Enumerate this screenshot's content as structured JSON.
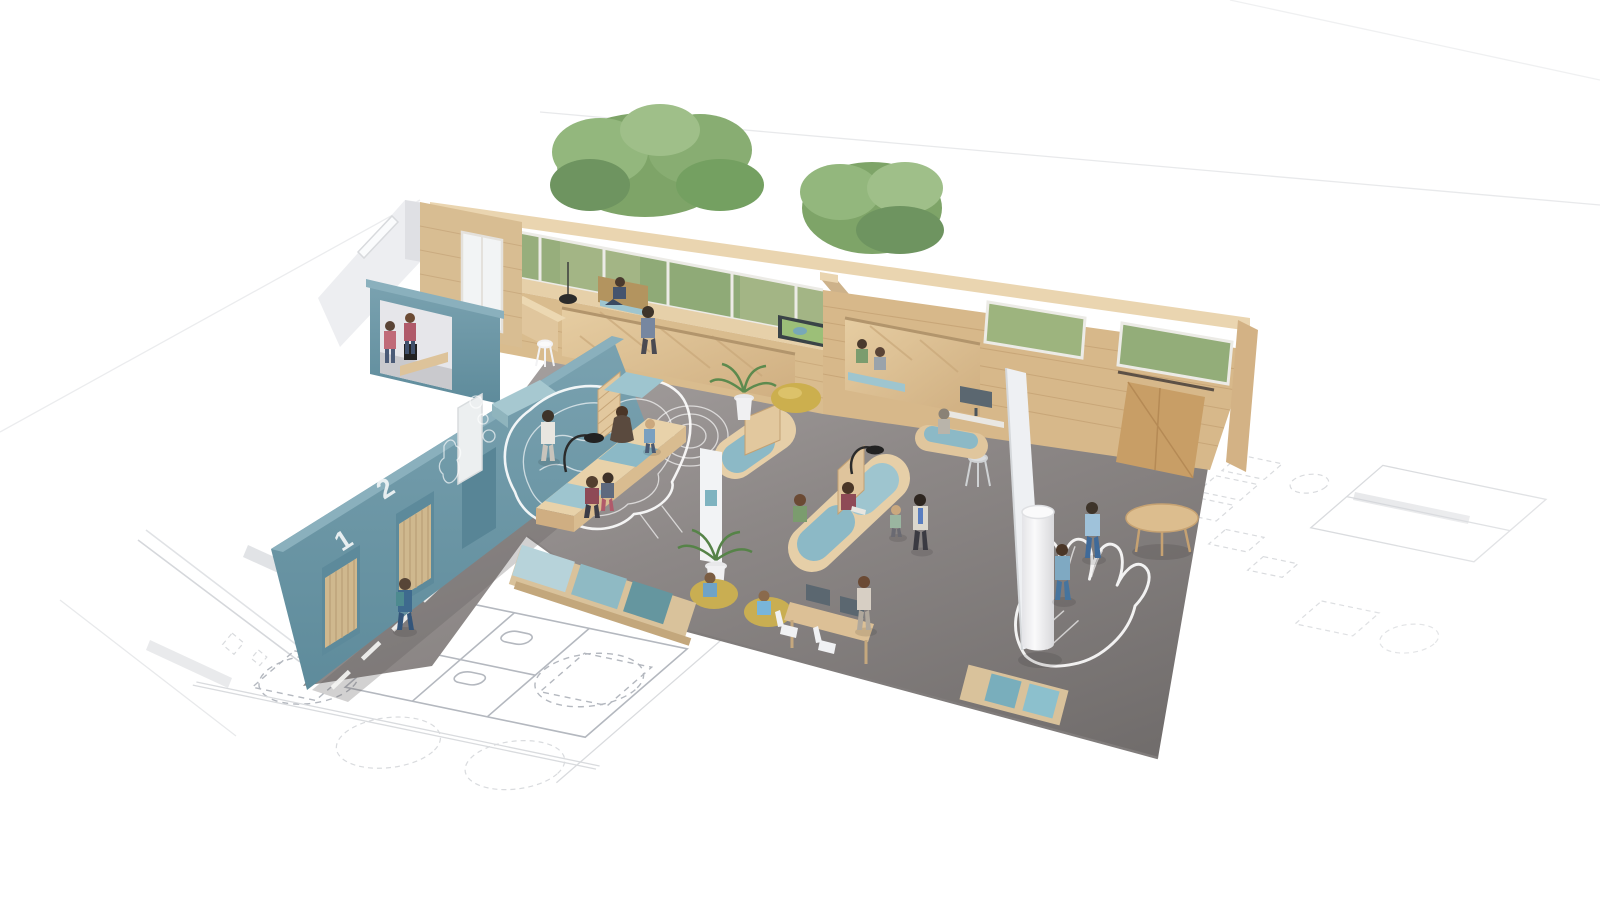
{
  "scene": {
    "description": "Isometric 3D cutaway rendering of a wooden office interior with teal accent wall, placed over a faint architectural blueprint floor plan",
    "door_labels": {
      "door_1": "1",
      "door_2": "2"
    },
    "palette": {
      "background": "#ffffff",
      "blueprint_line": "#b4b8bf",
      "blueprint_line_faint": "#d9dbde",
      "floor_gray": "#8d8887",
      "teal_wall": "#6b96a6",
      "teal_cap": "#8ab0bd",
      "wood_light": "#e8d3ad",
      "wood_mid": "#d9bc8e",
      "wood_dark": "#c9a87a",
      "cushion_light": "#b7d3da",
      "cushion_mid": "#8fbac4",
      "cushion_dark": "#65969f",
      "window_greenery": "#9db47e",
      "tree_green": "#86a873",
      "pouf_yellow": "#ccaf4e",
      "chalk_white": "#ffffff",
      "partition_white": "#eef0f3"
    }
  }
}
